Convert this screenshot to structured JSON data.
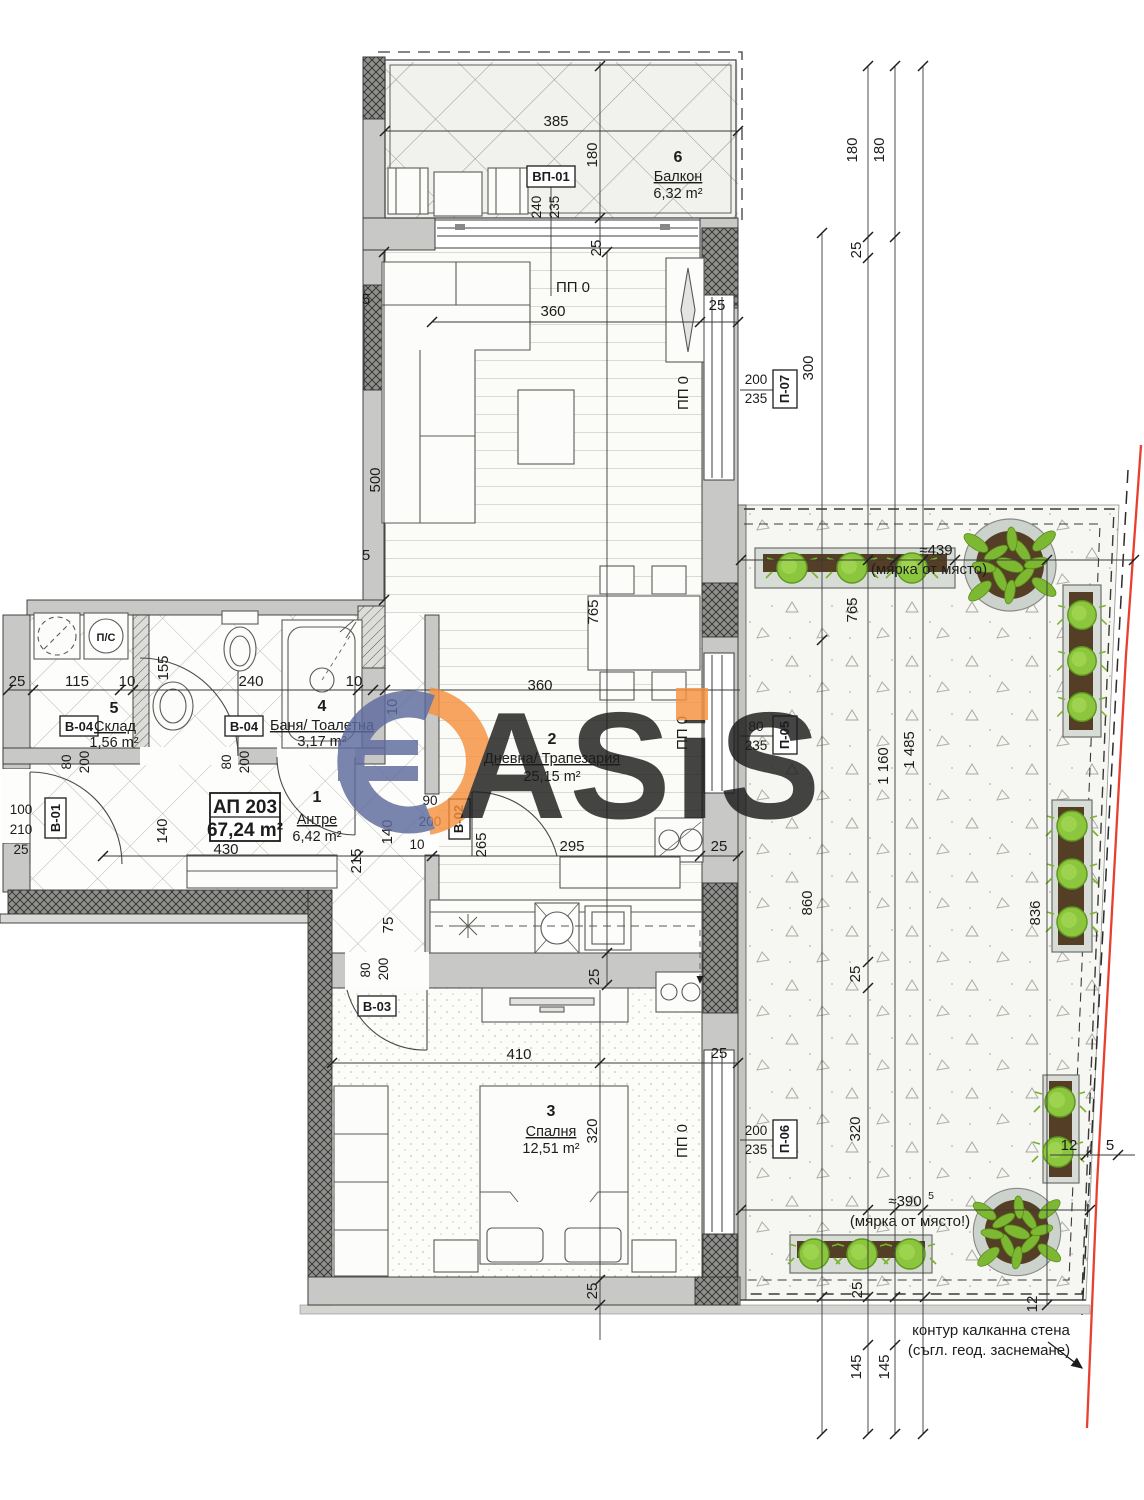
{
  "project": {
    "code": "АП 203",
    "area": "67,24 m²"
  },
  "rooms": {
    "balcony": {
      "number": "6",
      "name": "Балкон",
      "area": "6,32 m²"
    },
    "living": {
      "number": "2",
      "name": "Дневна/ Трапезария",
      "area": "25,15 m²"
    },
    "hall": {
      "number": "1",
      "name": "Антре",
      "area": "6,42 m²"
    },
    "storage": {
      "number": "5",
      "name": "Склад",
      "area": "1,56 m²"
    },
    "bath": {
      "number": "4",
      "name": "Баня/ Тоалетна",
      "area": "3,17 m²"
    },
    "bedroom": {
      "number": "3",
      "name": "Спалня",
      "area": "12,51 m²"
    }
  },
  "refs": {
    "vp01": "ВП-01",
    "p07": "П-07",
    "p05": "П-05",
    "p06": "П-06",
    "b01": "В-01",
    "b02": "В-02",
    "b03": "В-03",
    "b04": "В-04",
    "ps": "П/С",
    "pp0": "ПП 0"
  },
  "dims": {
    "d5": "5",
    "d10": "10",
    "d12": "12",
    "d25": "25",
    "d75": "75",
    "d80": "80",
    "d90": "90",
    "d100": "100",
    "d115": "115",
    "d140": "140",
    "d145": "145",
    "d155": "155",
    "d180": "180",
    "d200": "200",
    "d210": "210",
    "d215": "215",
    "d235": "235",
    "d240": "240",
    "d265": "265",
    "d295": "295",
    "d300": "300",
    "d320": "320",
    "d360": "360",
    "d385": "385",
    "d410": "410",
    "d430": "430",
    "d500": "500",
    "d765": "765",
    "d836": "836",
    "d860": "860",
    "d1160": "1 160",
    "d1485": "1 485"
  },
  "notes": {
    "approx_top": "≈439",
    "approx_top_note": "(мярка от място)",
    "approx_bottom": "≈390",
    "approx_bottom_sup": "5",
    "approx_bottom_note": "(мярка от място!)",
    "contour_line1": "контур калканна стена",
    "contour_line2": "(съгл. геод. заснемане)"
  },
  "watermark": {
    "letters": "ASiS"
  },
  "colors": {
    "boundary_red": "#e8402e",
    "plant_green": "#8cc63f",
    "logo_blue": "#5e6b9e",
    "logo_orange": "#f6923e"
  }
}
